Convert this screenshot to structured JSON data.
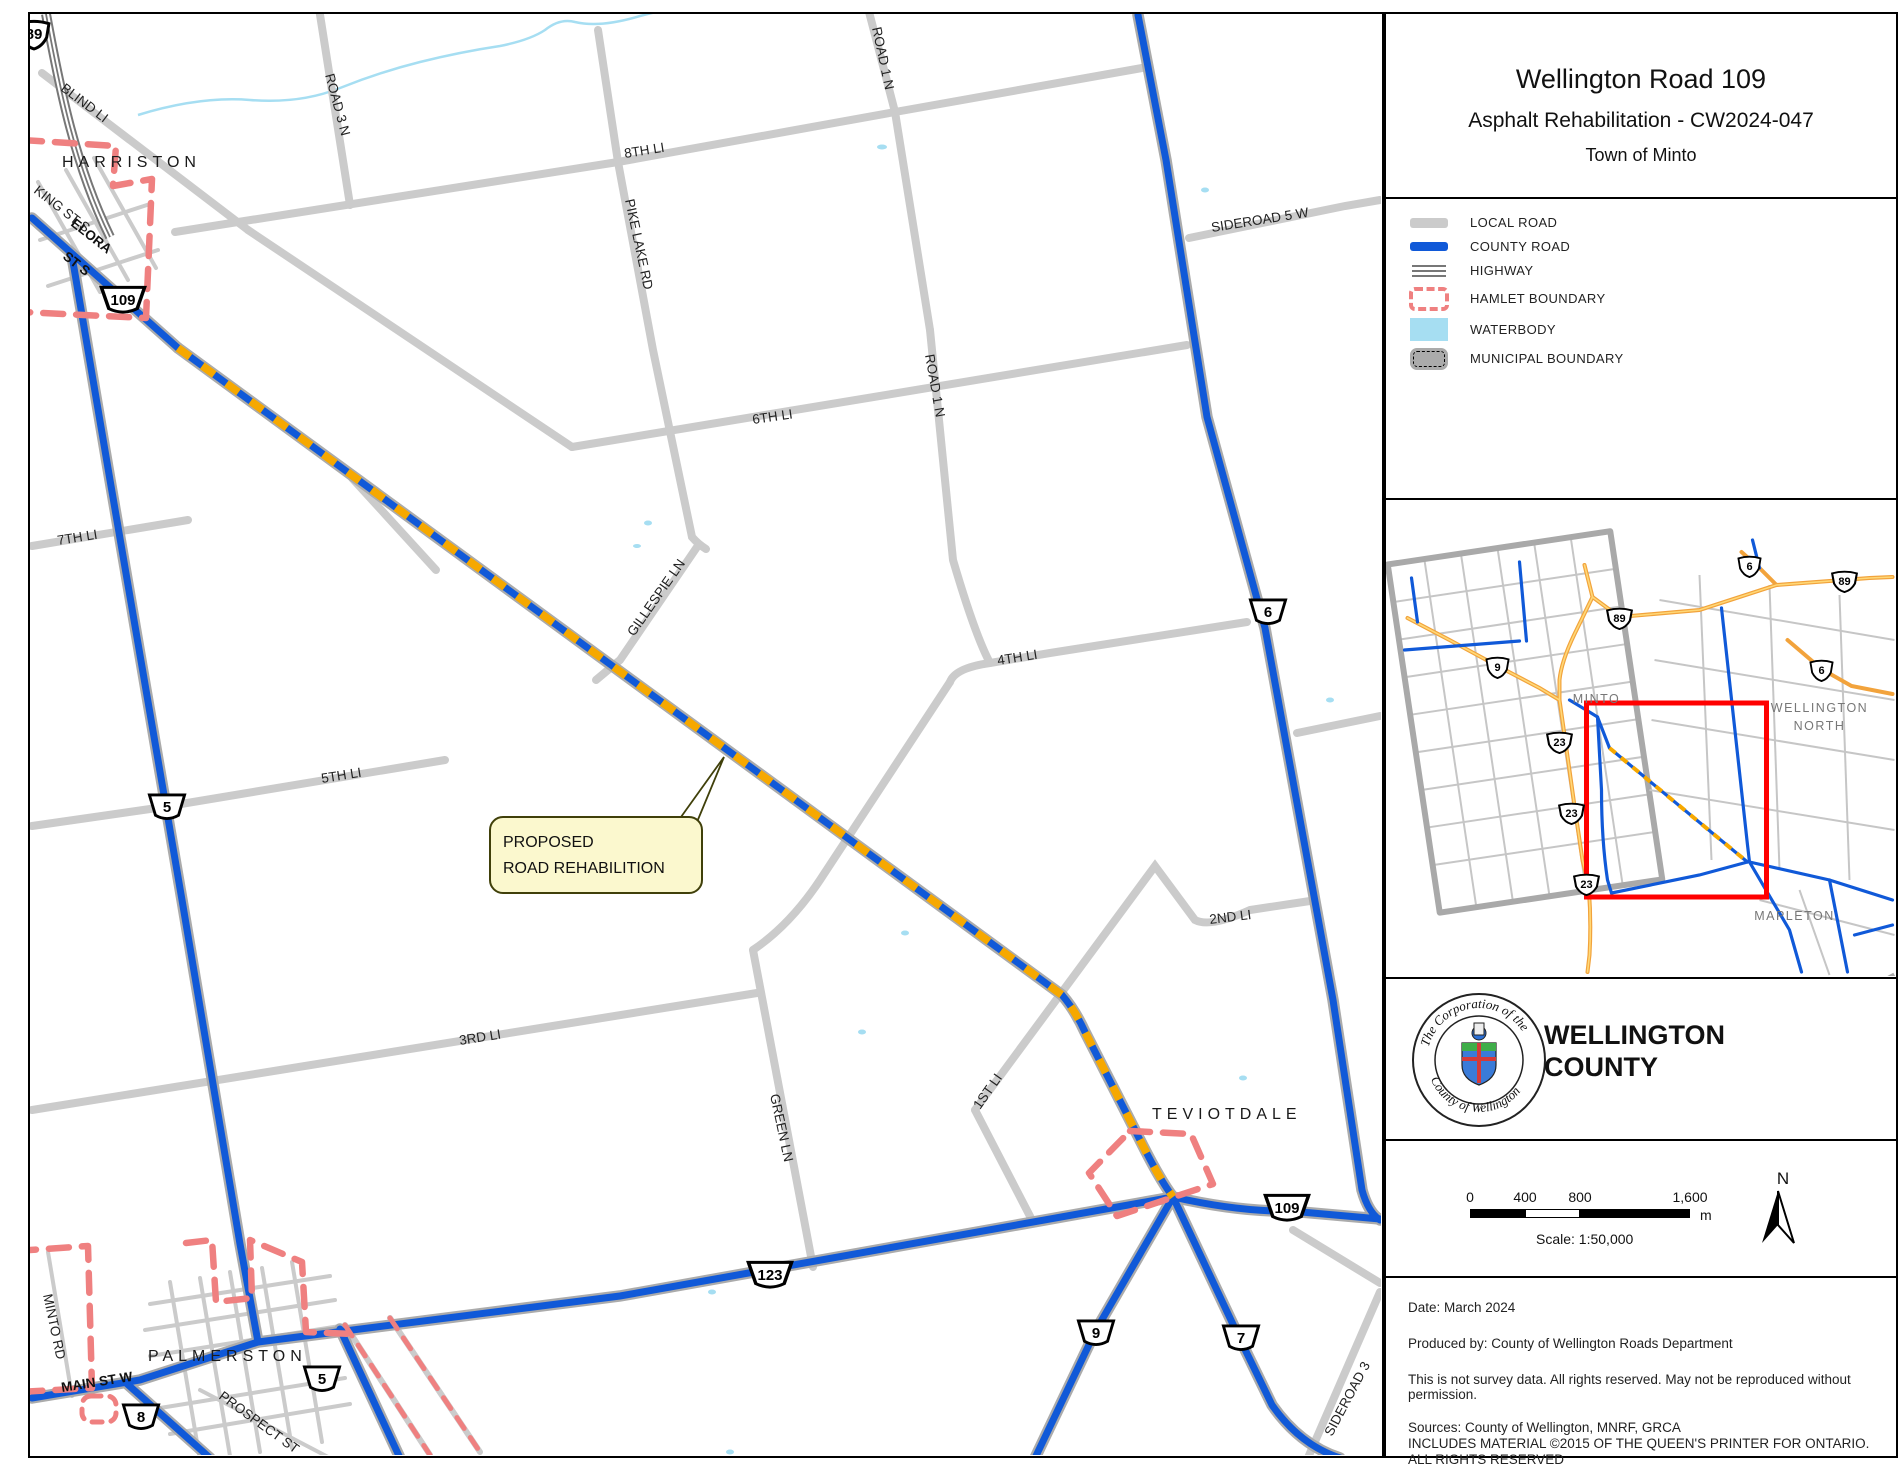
{
  "title_panel": {
    "line1": "Wellington Road 109",
    "line2": "Asphalt Rehabilitation - CW2024-047",
    "line3": "Town of Minto"
  },
  "legend": {
    "items": [
      {
        "label": "LOCAL ROAD"
      },
      {
        "label": "COUNTY ROAD"
      },
      {
        "label": "HIGHWAY"
      },
      {
        "label": "HAMLET BOUNDARY"
      },
      {
        "label": "WATERBODY"
      },
      {
        "label": "MUNICIPAL BOUNDARY"
      }
    ]
  },
  "inset": {
    "labels": {
      "minto": "MINTO",
      "wn1": "WELLINGTON",
      "wn2": "NORTH",
      "mapleton": "MAPLETON"
    },
    "shields": [
      {
        "num": "6"
      },
      {
        "num": "89"
      },
      {
        "num": "89"
      },
      {
        "num": "9"
      },
      {
        "num": "6"
      },
      {
        "num": "23"
      },
      {
        "num": "23"
      },
      {
        "num": "23"
      }
    ]
  },
  "logo": {
    "seal_top": "The Corporation of the",
    "seal_bottom": "County of Wellington",
    "name1": "WELLINGTON",
    "name2": "COUNTY"
  },
  "scalebar": {
    "t0": "0",
    "t400": "400",
    "t800": "800",
    "t1600": "1,600",
    "unit": "m",
    "scale_text": "Scale: 1:50,000",
    "north": "N"
  },
  "footer": {
    "date": "Date: March 2024",
    "produced": "Produced by: County of Wellington Roads Department",
    "disclaimer": "This is not survey data. All rights reserved. May not be reproduced without permission.",
    "sources1": "Sources: County of Wellington, MNRF, GRCA",
    "sources2": "INCLUDES MATERIAL ©2015 OF THE QUEEN'S PRINTER FOR ONTARIO. ALL RIGHTS RESERVED"
  },
  "map": {
    "callout": {
      "line1": "PROPOSED",
      "line2": "ROAD REHABILITION"
    },
    "places": [
      {
        "name": "HARRISTON"
      },
      {
        "name": "TEVIOTDALE"
      },
      {
        "name": "PALMERSTON"
      }
    ],
    "road_labels": [
      {
        "text": "BLIND LI"
      },
      {
        "text": "ROAD 3 N"
      },
      {
        "text": "8TH LI"
      },
      {
        "text": "PIKE LAKE RD"
      },
      {
        "text": "ROAD 1 N"
      },
      {
        "text": "ROAD 1 N"
      },
      {
        "text": "SIDEROAD 5 W"
      },
      {
        "text": "6TH LI"
      },
      {
        "text": "7TH LI"
      },
      {
        "text": "GILLESPIE LN"
      },
      {
        "text": "4TH LI"
      },
      {
        "text": "5TH LI"
      },
      {
        "text": "2ND LI"
      },
      {
        "text": "3RD LI"
      },
      {
        "text": "GREEN LN"
      },
      {
        "text": "1ST LI"
      },
      {
        "text": "KING ST S"
      },
      {
        "text": "ELORA"
      },
      {
        "text": "ST S"
      },
      {
        "text": "MAIN ST W"
      },
      {
        "text": "PROSPECT ST"
      },
      {
        "text": "MINTO RD"
      },
      {
        "text": "SIDEROAD 3"
      }
    ],
    "shields": [
      {
        "num": "89"
      },
      {
        "num": "109"
      },
      {
        "num": "5"
      },
      {
        "num": "6"
      },
      {
        "num": "109"
      },
      {
        "num": "123"
      },
      {
        "num": "9"
      },
      {
        "num": "7"
      },
      {
        "num": "5"
      },
      {
        "num": "8"
      }
    ]
  },
  "colors": {
    "county_road": "#1059d8",
    "rehab_dash": "#f6a800",
    "local_road": "#cbcbcb",
    "hamlet_boundary": "#ef8080",
    "waterbody": "#a6def2",
    "inset_highlight": "#ff0000",
    "callout_fill": "#fbf8ce"
  }
}
